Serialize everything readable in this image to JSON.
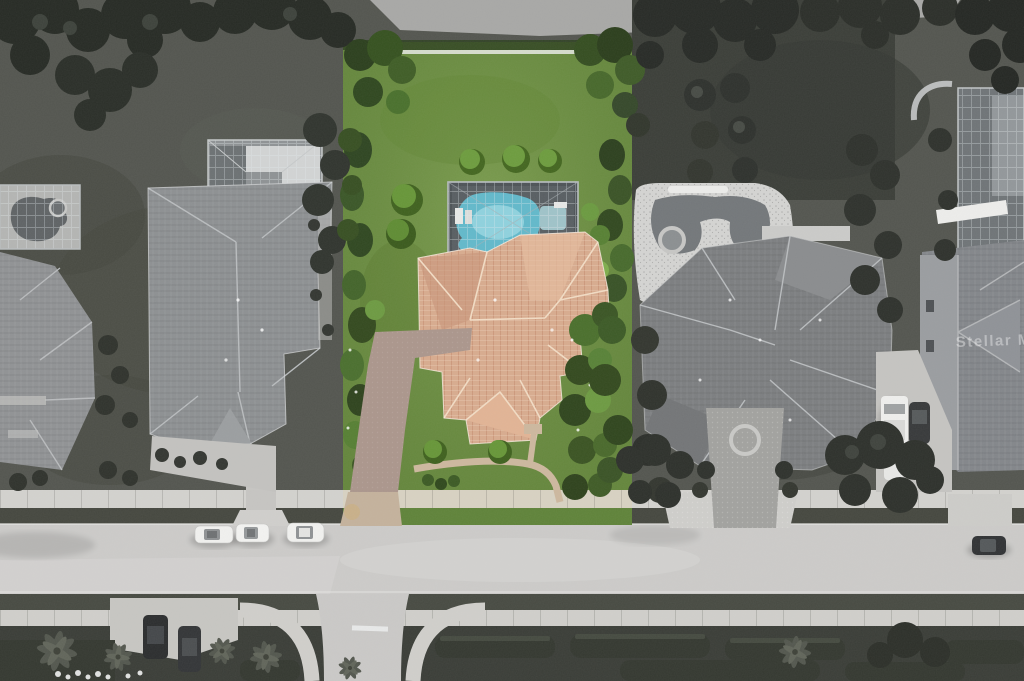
{
  "image": {
    "kind": "aerial drone photograph",
    "description": "Overhead real-estate listing photo of a residential street. The featured lot in the center is rendered in full color while all neighboring properties, the road and landscaping are desaturated to grayscale.",
    "width_px": 1024,
    "height_px": 681
  },
  "watermark": {
    "text": "Stellar MLS"
  },
  "palette": {
    "featured_grass": "#6b8d41",
    "featured_grass_light": "#86a857",
    "featured_hedge": "#33491f",
    "shrub_ball": "#5f8a38",
    "pool_water": "#62b9cb",
    "pool_water_light": "#9fdbe4",
    "pool_deck": "#585e62",
    "roof_tile": "#d8ab8e",
    "roof_ridge": "#f2dcc4",
    "driveway": "#ab968c",
    "walkway": "#cdb89e",
    "apron": "#c4b29c",
    "sidewalk": "#d3d2ce",
    "road": "#cccbc9",
    "gray_lawn": "#4c4e48",
    "gray_tree": "#2d302b",
    "gray_roof_left": "#8d9092",
    "gray_roof_right": "#7c7e80",
    "gray_ridge": "#b9bcbe",
    "pool_deck_gray": "#d4d4d2",
    "screen_cage": "#6f7477",
    "white_car": "#f1f1ef",
    "dark_car": "#303234"
  },
  "featured_lot": {
    "label": "Featured property shown in color",
    "features": [
      "rear lawn with white fence",
      "three trimmed shrub balls",
      "screened pool enclosure",
      "free-form swimming pool with spa and lounge chairs",
      "tile hip roof house",
      "driveway to street",
      "curved front walkway",
      "privacy hedges left and right",
      "tropical front planting beds"
    ]
  },
  "surroundings": {
    "label": "Neighboring properties in grayscale",
    "left_house": [
      "hip-roof house",
      "screened lanai",
      "driveway crossing to road"
    ],
    "far_left_house": [
      "corner of house",
      "screened pool with kidney-shaped water"
    ],
    "right_house": [
      "large multi-hip roof house",
      "free-form pool with round spa on speckled deck",
      "trimmed hedge balls",
      "paver entry court with circle motif"
    ],
    "far_right_house": [
      "pool screen enclosure",
      "gabled roof",
      "driveway with white pickup truck, dark SUV and white car"
    ]
  },
  "street": {
    "road_parked_white_cars": 3,
    "road_parked_dark_cars": 1,
    "bottom_parked_dark_cars": 2,
    "elements": [
      "upper sidewalk",
      "grass verges",
      "concrete road",
      "driveway aprons",
      "side-street intersection with curved sidewalks",
      "white stop bar",
      "lower sidewalk",
      "median planting with palm trees and hedges"
    ]
  }
}
